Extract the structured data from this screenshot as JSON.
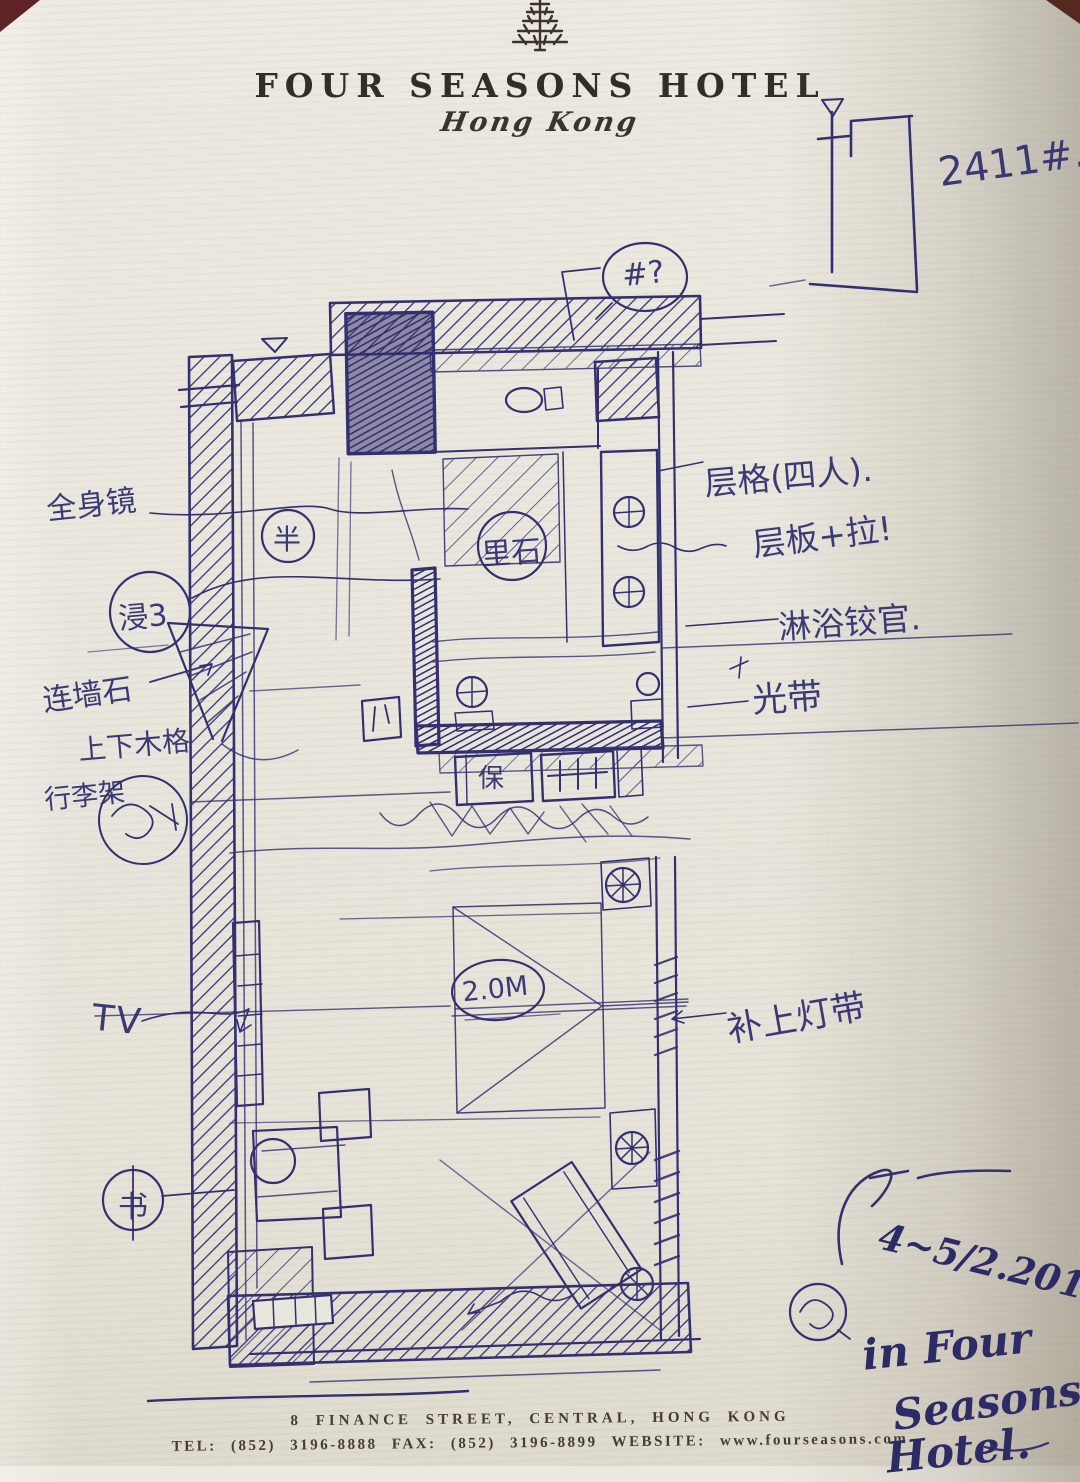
{
  "colors": {
    "paper": "#e9e6dd",
    "ink": "#34306f",
    "header_text": "#332d28"
  },
  "header": {
    "logo": "four-seasons-tree-icon",
    "title": "FOUR SEASONS HOTEL",
    "city": "Hong Kong"
  },
  "plan": {
    "room_ref": "2411#.",
    "query_mark": "#?",
    "bed_width": "2.0M",
    "safe": "保",
    "desk": "书",
    "zone_a": "半",
    "zone_b": "里石",
    "zone_c": "浸3",
    "tv": "TV"
  },
  "notes": {
    "mirror": "全身镜",
    "stone": "连墙石",
    "shelf": "上下木格",
    "luggage": "行李架",
    "compartments": "层格(四人).",
    "board": "层板+拉!",
    "shower": "淋浴铰官.",
    "lightband": "光带",
    "add_light": "补上灯带"
  },
  "inscription": {
    "date": "4~5/2.2013",
    "line1": "in Four",
    "line2": "Seasons",
    "line3": "Hotel."
  },
  "footer": {
    "address": "8 FINANCE STREET, CENTRAL, HONG KONG",
    "contacts": "TEL: (852) 3196-8888    FAX: (852) 3196-8899    WEBSITE: www.fourseasons.com"
  }
}
